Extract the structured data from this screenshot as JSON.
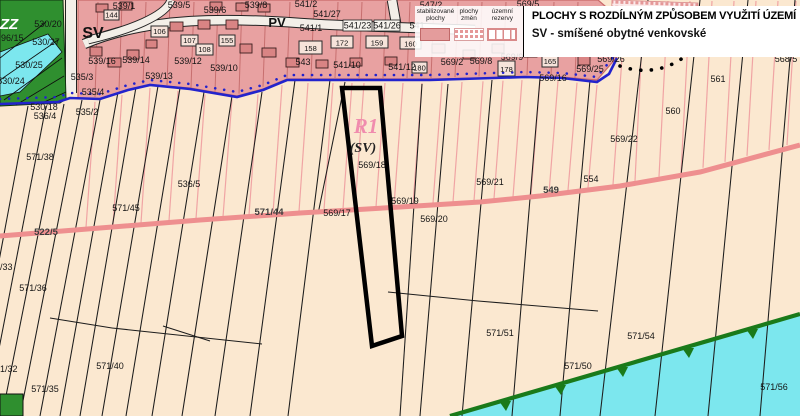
{
  "legend": {
    "title": "PLOCHY S ROZDÍLNÝM ZPŮSOBEM VYUŽITÍ ÚZEMÍ",
    "col_stabilized": "stabilizované plochy",
    "col_changes": "plochy změn",
    "col_reserves": "územní rezervy",
    "sv_entry": "SV - smíšené obytné venkovské"
  },
  "areas": {
    "zz": "ZZ",
    "sv": "SV",
    "pv": "PV",
    "r1": "R1",
    "r1_type": "(SV)"
  },
  "parcels": {
    "p539_1": "539/1",
    "p539_5": "539/5",
    "p539_6": "539/6",
    "p539_8": "539/8",
    "p541_2": "541/2",
    "p547_2": "547/2",
    "p569_5": "569/5",
    "p530_20": "530/20",
    "p96_15": "96/15",
    "p530_27": "530/27",
    "p530_25": "530/25",
    "p530_24": "530/24",
    "p530_18": "530/18",
    "p536_4": "536/4",
    "p539_16": "539/16",
    "p539_14": "539/14",
    "p539_12": "539/12",
    "p539_13": "539/13",
    "p539_10": "539/10",
    "p535_3": "535/3",
    "p535_4": "535/4",
    "p535_2": "535/2",
    "p543": "543",
    "p541_27": "541/27",
    "p541_1": "541/1",
    "p541_23": "541/23",
    "p541_26": "541/26",
    "p541": "541",
    "p541_10": "541/10",
    "p541_12": "541/12",
    "p569_2": "569/2",
    "p569_8": "569/8",
    "p569_9": "569/9",
    "p569_25": "569/25",
    "p569_16": "569/16",
    "p569_26": "569/26",
    "p568_5": "568/5",
    "p561": "561",
    "p560": "560",
    "p569_22": "569/22",
    "p571_38": "571/38",
    "p536_5": "536/5",
    "p571_45": "571/45",
    "p522_5": "522/5",
    "p571_44": "571/44",
    "p549": "549",
    "p554": "554",
    "p569_21": "569/21",
    "p569_17": "569/17",
    "p569_18": "569/18",
    "p569_19": "569/19",
    "p569_20": "569/20",
    "p571_33": "571/33",
    "p571_36": "571/36",
    "p571_32": "571/32",
    "p571_35": "571/35",
    "p571_40": "571/40",
    "p571_51": "571/51",
    "p571_50": "571/50",
    "p571_54": "571/54",
    "p571_56": "571/56"
  },
  "houses": {
    "h106": "106",
    "h107": "107",
    "h108": "108",
    "h144": "144",
    "h155": "155",
    "h158": "158",
    "h172": "172",
    "h159": "159",
    "h160": "160",
    "h180": "180",
    "h178": "178",
    "h165": "165"
  },
  "colors": {
    "field": "#fbe8d0",
    "pink-band": "#e8a1a1",
    "band-line": "#c76f6f",
    "band-border": "#c96a6a",
    "field-line-pink": "#f0a4a4",
    "field-line-black": "#1c1c1c",
    "road-pink": "#ee8f8f",
    "boundary-blue": "#2323cc",
    "green-area": "#2f8f2f",
    "cyan-area": "#7ce7ee",
    "green-boundary": "#1a7a1a",
    "white-road": "#f3efe8",
    "r1-label": "#f08cae",
    "house-fill": "#d98484",
    "r1-outline": "#000000"
  }
}
